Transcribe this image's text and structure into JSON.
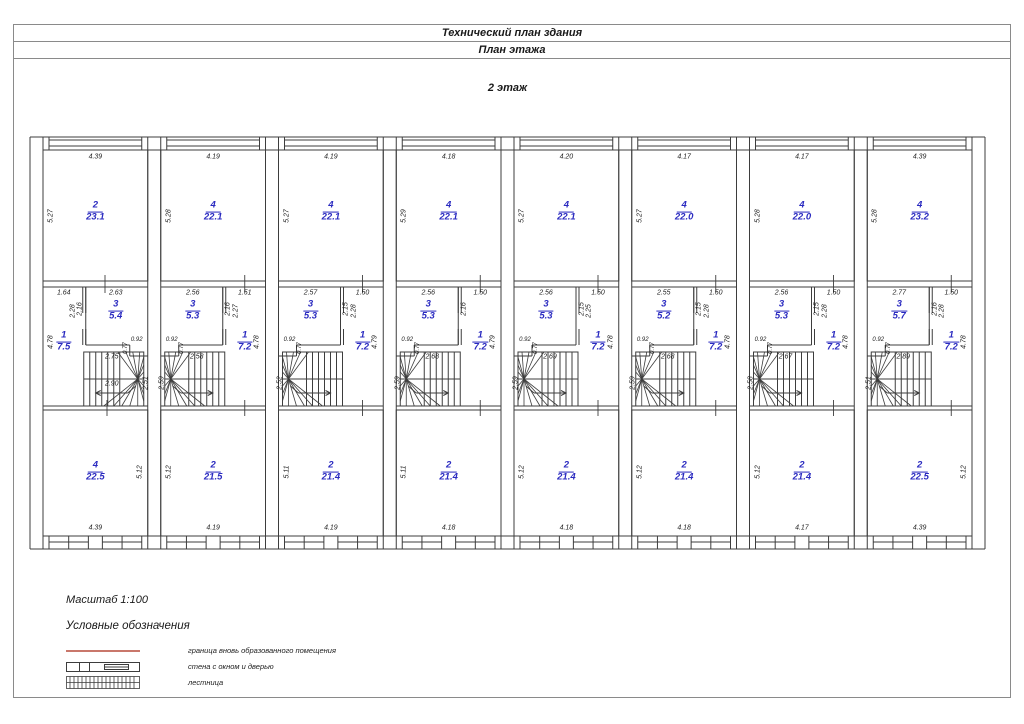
{
  "page": {
    "title1": "Технический план здания",
    "title2": "План этажа",
    "floor_label": "2 этаж"
  },
  "colors": {
    "room_label_blue": "#2a2ac0",
    "new_boundary_red": "#c9776b",
    "linework": "#3d3d3d"
  },
  "legend": {
    "scale": "Масштаб 1:100",
    "heading": "Условные обозначения",
    "items": [
      {
        "symbol": "red-line",
        "label": "граница вновь образованного помещения"
      },
      {
        "symbol": "wall-with-window-and-door",
        "label": "стена с окном и дверью"
      },
      {
        "symbol": "stairs-hatch",
        "label": "лестница"
      }
    ]
  },
  "units": [
    {
      "mirrored": true,
      "top": {
        "width": "4.39",
        "height": "5.27",
        "room_num": "2",
        "room_area": "23.1"
      },
      "middle": {
        "room3_dim": "2.63",
        "corridor_dim": "1.64",
        "room3_num": "3",
        "room3_area": "5.4",
        "part_inner": "2.16",
        "part_outer": "2.28",
        "notch_w": "0.92",
        "notch_h": "0.77",
        "stair_w": "2.75",
        "stair_w2": "2.90",
        "stair_h": "2.51",
        "room1_num": "1",
        "room1_area": "7.5",
        "room1_h": "4.78"
      },
      "bottom": {
        "room_num": "4",
        "room_area": "22.5",
        "height": "5.12",
        "height_side": "right",
        "width": "4.39"
      }
    },
    {
      "mirrored": false,
      "top": {
        "width": "4.19",
        "height": "5.28",
        "room_num": "4",
        "room_area": "22.1"
      },
      "middle": {
        "room3_dim": "2.56",
        "corridor_dim": "1.51",
        "room3_num": "3",
        "room3_area": "5.3",
        "part_inner": "2.16",
        "part_outer": "2.27",
        "notch_w": "0.92",
        "notch_h": "0.77",
        "stair_w": "2.58",
        "stair_w2": "",
        "stair_h": "2.59",
        "room1_num": "1",
        "room1_area": "7.2",
        "room1_h": "4.78"
      },
      "bottom": {
        "room_num": "2",
        "room_area": "21.5",
        "height": "5.12",
        "height_side": "left",
        "width": "4.19"
      }
    },
    {
      "mirrored": false,
      "top": {
        "width": "4.19",
        "height": "5.27",
        "room_num": "4",
        "room_area": "22.1"
      },
      "middle": {
        "room3_dim": "2.57",
        "corridor_dim": "1.50",
        "room3_num": "3",
        "room3_area": "5.3",
        "part_inner": "2.15",
        "part_outer": "2.28",
        "notch_w": "0.92",
        "notch_h": "0.77",
        "stair_w": "",
        "stair_w2": "",
        "stair_h": "2.52",
        "room1_num": "1",
        "room1_area": "7.2",
        "room1_h": "4.79"
      },
      "bottom": {
        "room_num": "2",
        "room_area": "21.4",
        "height": "5.11",
        "height_side": "left",
        "width": "4.19"
      }
    },
    {
      "mirrored": false,
      "top": {
        "width": "4.18",
        "height": "5.29",
        "room_num": "4",
        "room_area": "22.1"
      },
      "middle": {
        "room3_dim": "2.56",
        "corridor_dim": "1.50",
        "room3_num": "3",
        "room3_area": "5.3",
        "part_inner": "2.16",
        "part_outer": "",
        "notch_w": "0.92",
        "notch_h": "0.77",
        "stair_w": "2.68",
        "stair_w2": "",
        "stair_h": "2.59",
        "room1_num": "1",
        "room1_area": "7.2",
        "room1_h": "4.79"
      },
      "bottom": {
        "room_num": "2",
        "room_area": "21.4",
        "height": "5.11",
        "height_side": "left",
        "width": "4.18"
      }
    },
    {
      "mirrored": false,
      "top": {
        "width": "4.20",
        "height": "5.27",
        "room_num": "4",
        "room_area": "22.1"
      },
      "middle": {
        "room3_dim": "2.56",
        "corridor_dim": "1.50",
        "room3_num": "3",
        "room3_area": "5.3",
        "part_inner": "2.15",
        "part_outer": "2.25",
        "notch_w": "0.92",
        "notch_h": "0.77",
        "stair_w": "2.69",
        "stair_w2": "",
        "stair_h": "2.59",
        "room1_num": "1",
        "room1_area": "7.2",
        "room1_h": "4.78"
      },
      "bottom": {
        "room_num": "2",
        "room_area": "21.4",
        "height": "5.12",
        "height_side": "left",
        "width": "4.18"
      }
    },
    {
      "mirrored": false,
      "top": {
        "width": "4.17",
        "height": "5.27",
        "room_num": "4",
        "room_area": "22.0"
      },
      "middle": {
        "room3_dim": "2.55",
        "corridor_dim": "1.50",
        "room3_num": "3",
        "room3_area": "5.2",
        "part_inner": "2.15",
        "part_outer": "2.28",
        "notch_w": "0.92",
        "notch_h": "0.77",
        "stair_w": "2.68",
        "stair_w2": "",
        "stair_h": "2.59",
        "room1_num": "1",
        "room1_area": "7.2",
        "room1_h": "4.78"
      },
      "bottom": {
        "room_num": "2",
        "room_area": "21.4",
        "height": "5.12",
        "height_side": "left",
        "width": "4.18"
      }
    },
    {
      "mirrored": false,
      "top": {
        "width": "4.17",
        "height": "5.28",
        "room_num": "4",
        "room_area": "22.0"
      },
      "middle": {
        "room3_dim": "2.56",
        "corridor_dim": "1.50",
        "room3_num": "3",
        "room3_area": "5.3",
        "part_inner": "2.15",
        "part_outer": "2.28",
        "notch_w": "0.92",
        "notch_h": "0.77",
        "stair_w": "2.67",
        "stair_w2": "",
        "stair_h": "2.58",
        "room1_num": "1",
        "room1_area": "7.2",
        "room1_h": "4.78"
      },
      "bottom": {
        "room_num": "2",
        "room_area": "21.4",
        "height": "5.12",
        "height_side": "left",
        "width": "4.17"
      }
    },
    {
      "mirrored": false,
      "top": {
        "width": "4.39",
        "height": "5.28",
        "room_num": "4",
        "room_area": "23.2"
      },
      "middle": {
        "room3_dim": "2.77",
        "corridor_dim": "1.50",
        "room3_num": "3",
        "room3_area": "5.7",
        "part_inner": "2.16",
        "part_outer": "2.28",
        "notch_w": "0.92",
        "notch_h": "0.77",
        "stair_w": "2.89",
        "stair_w2": "",
        "stair_h": "2.51",
        "room1_num": "1",
        "room1_area": "7.2",
        "room1_h": "4.78"
      },
      "bottom": {
        "room_num": "2",
        "room_area": "22.5",
        "height": "5.12",
        "height_side": "right",
        "width": "4.39"
      }
    }
  ]
}
